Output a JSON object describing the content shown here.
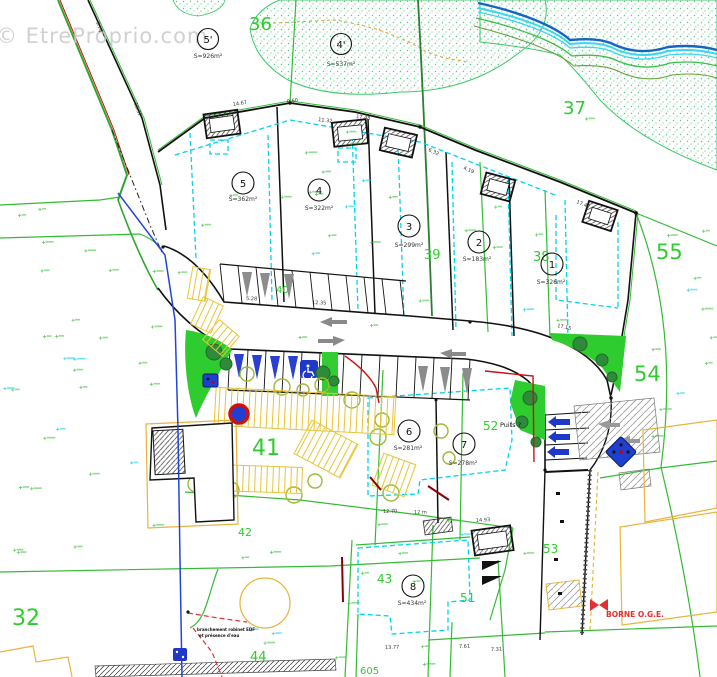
{
  "watermark": "© EtreProprio.com",
  "map": {
    "parcel_labels": {
      "p36": "36",
      "p37": "37",
      "p55": "55",
      "p54": "54",
      "p53": "53",
      "p52": "52",
      "p51": "51",
      "p44": "44",
      "p43": "43",
      "p42": "42",
      "p41": "41",
      "p40": "40",
      "p39": "39",
      "p38": "38",
      "p32": "32",
      "p605": "605"
    },
    "lots": [
      {
        "num": "5'",
        "area": "S=926m²"
      },
      {
        "num": "4'",
        "area": "S=537m²"
      },
      {
        "num": "5",
        "area": "S=362m²"
      },
      {
        "num": "4",
        "area": "S=322m²"
      },
      {
        "num": "3",
        "area": "S=299m²"
      },
      {
        "num": "2",
        "area": "S=183m²"
      },
      {
        "num": "1",
        "area": "S=326m²"
      },
      {
        "num": "6",
        "area": "S=281m²"
      },
      {
        "num": "7",
        "area": "S=278m²"
      },
      {
        "num": "8",
        "area": "S=434m²"
      }
    ],
    "dimensions": [
      "14.67",
      "11.32",
      "17.48",
      "17.42",
      "5.28",
      "12.35",
      "17.15",
      "12.70",
      "12 m",
      "14.93",
      "13.77",
      "7.61",
      "7.31",
      "4.19",
      "6.32",
      "9.74",
      "18.37",
      "0.60"
    ],
    "annotations": {
      "puits": "Puits ?",
      "borne": "BORNE O.G.E.",
      "note1": "branchement robinet EDF",
      "note2": "et présence d'eau"
    },
    "icons": {
      "handicap": "handicap-parking-icon",
      "tree": "tree-icon",
      "utility": "utility-marker-icon",
      "borne_symbol": "survey-borne-icon"
    },
    "colors": {
      "parcel_green": "#2ECC2E",
      "boundary_green": "#33BB33",
      "cyan_dashed": "#00D5EE",
      "river_blue": "#1565C0",
      "river_cyan": "#39D7EF",
      "hatch_yellow": "#E8C437",
      "red": "#CC1111",
      "parking_blue": "#2038C8",
      "stipple_green": "#52C97B"
    }
  }
}
